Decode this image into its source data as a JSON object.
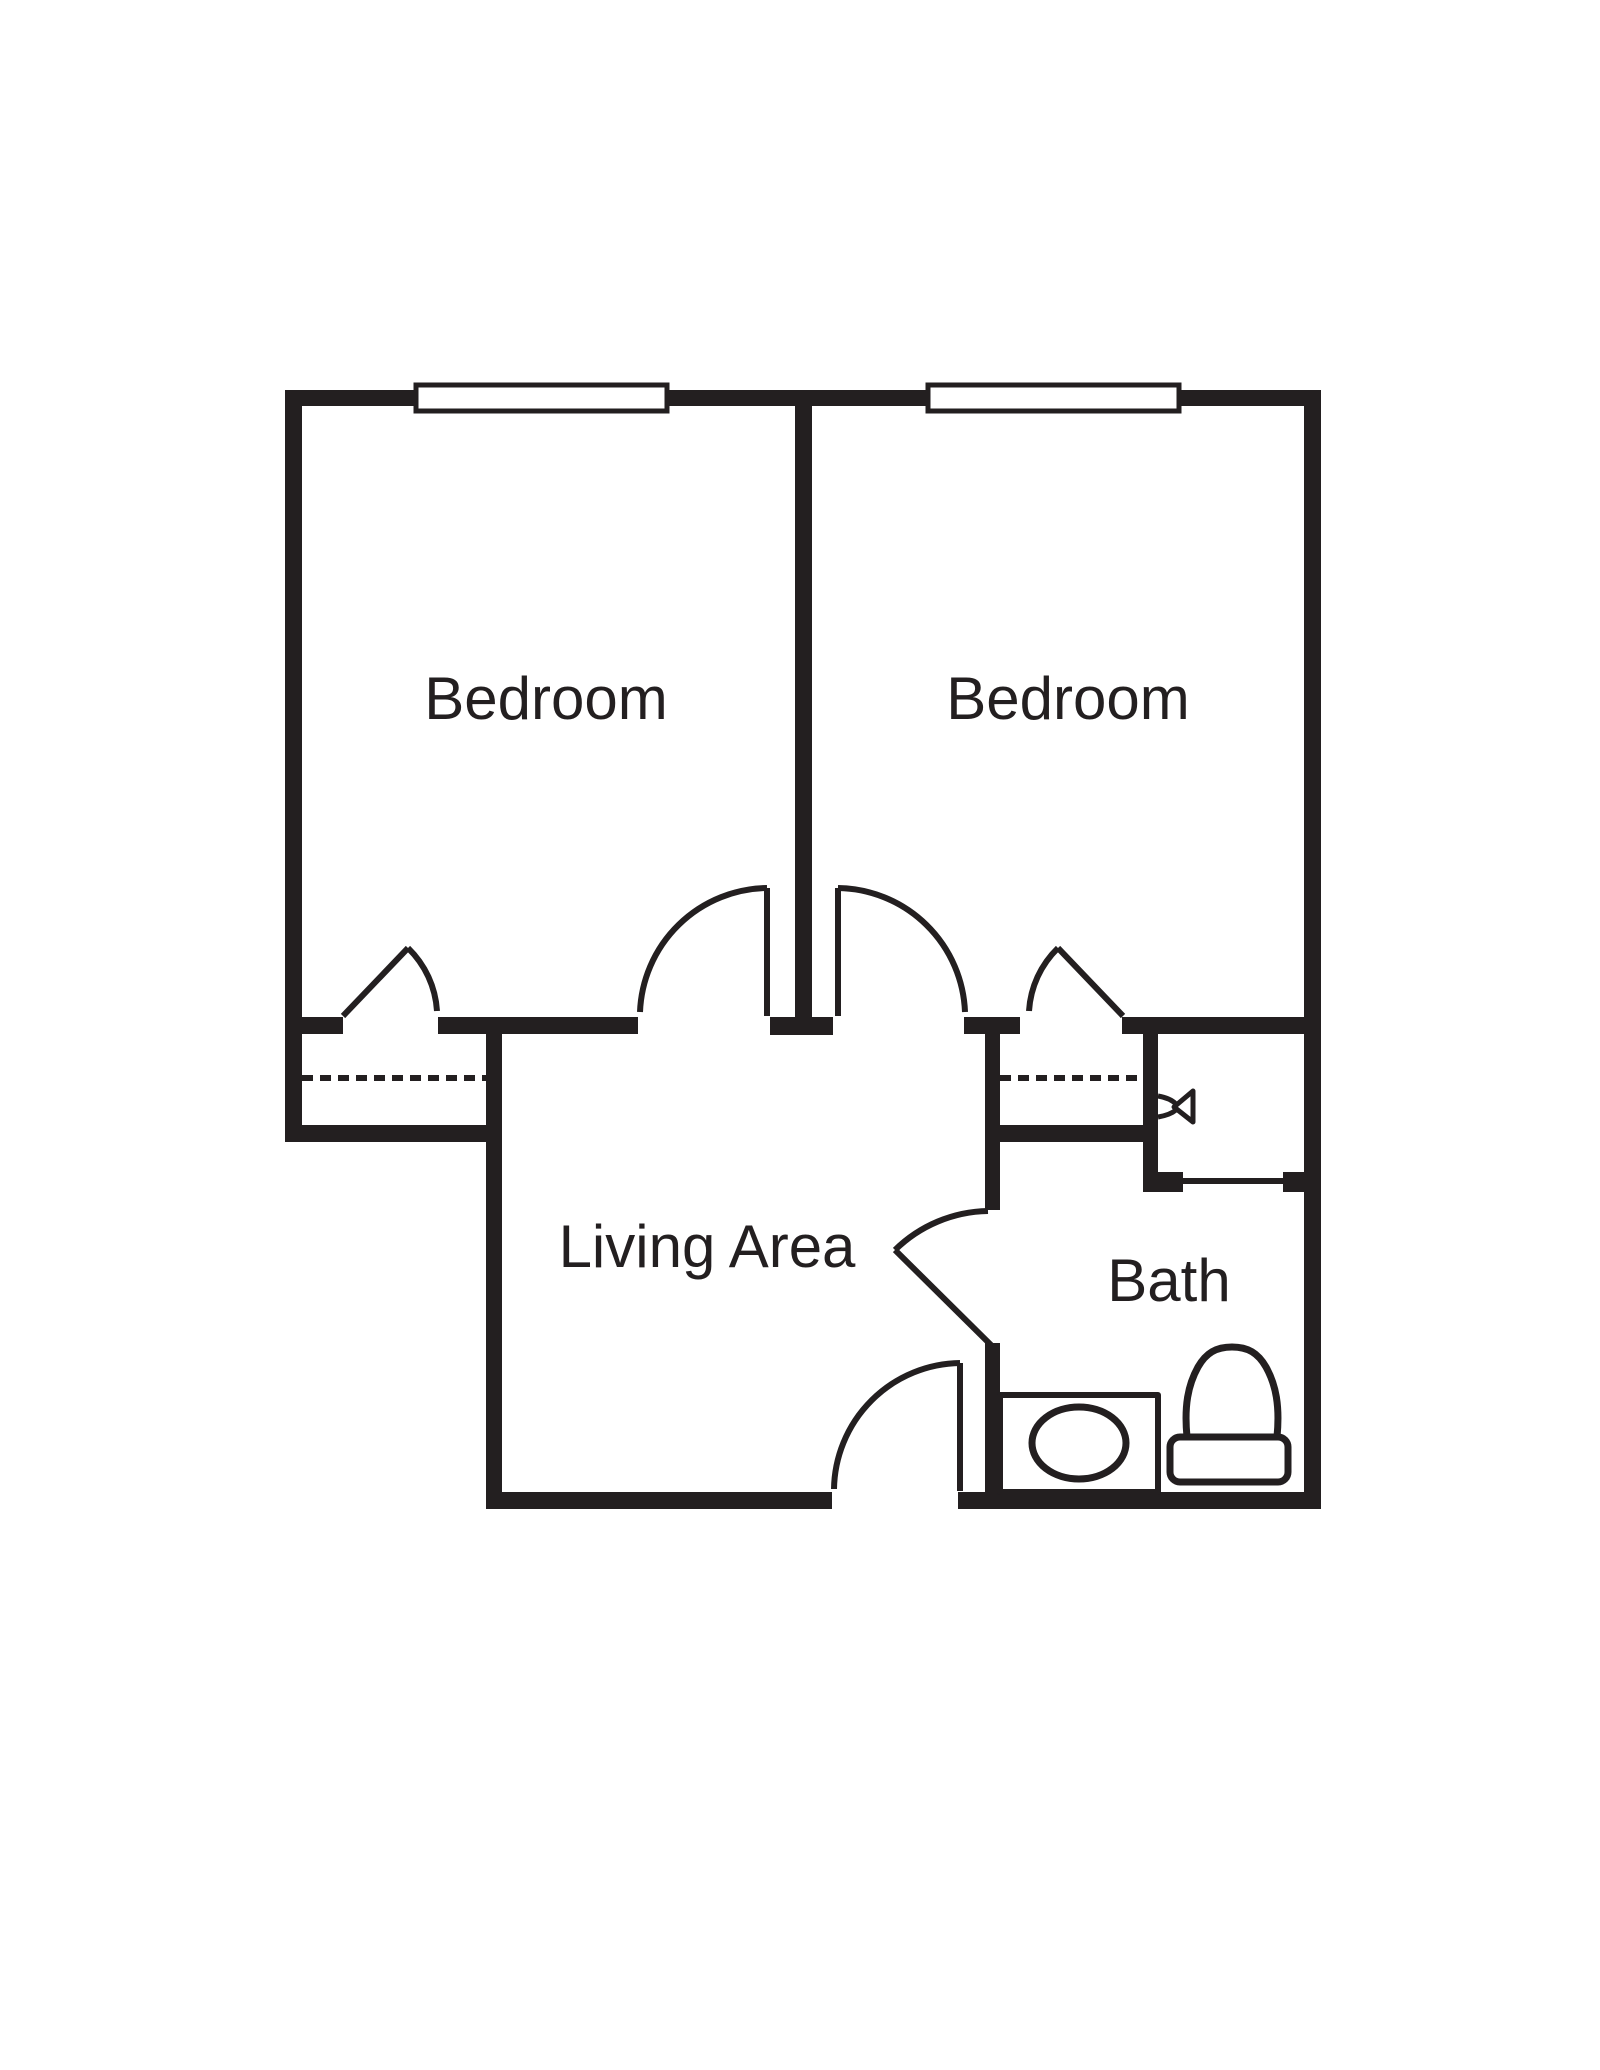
{
  "title": "Apartment floor plan",
  "colors": {
    "ink": "#231f20",
    "paper": "#ffffff"
  },
  "rooms": {
    "bedroom1": {
      "label": "Bedroom"
    },
    "bedroom2": {
      "label": "Bedroom"
    },
    "living": {
      "label": "Living Area"
    },
    "bath": {
      "label": "Bath"
    }
  },
  "icons": {
    "windows": "window-icon",
    "door_swings": "door-swing-icon",
    "closet_rods": "closet-rod-dashed-line",
    "shower_head": "shower-head-icon",
    "sink": "sink-icon",
    "toilet": "toilet-icon"
  }
}
